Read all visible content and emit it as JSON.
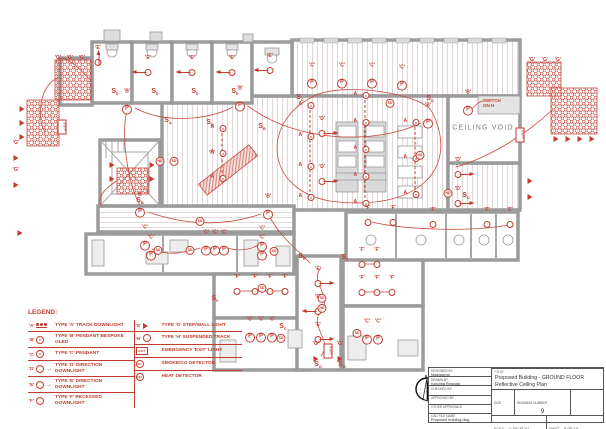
{
  "colors": {
    "annotation_red": "#c23b2e",
    "wall_gray": "#9b9b9b",
    "stripe_pink": "#e3d8d8",
    "furniture_gray": "#dedede",
    "plan_text_gray": "#7a7a7a"
  },
  "plan": {
    "ceiling_void_label": "CEILING VOID",
    "north_label": "N",
    "symbols": [
      {
        "t": "direction",
        "x": 148,
        "y": 72,
        "d": "left",
        "l": "'E'"
      },
      {
        "t": "direction",
        "x": 192,
        "y": 72,
        "d": "left",
        "l": "'E'"
      },
      {
        "t": "direction",
        "x": 232,
        "y": 72,
        "d": "left",
        "l": "'E'"
      },
      {
        "t": "direction",
        "x": 270,
        "y": 70,
        "d": "left",
        "l": "'E'"
      },
      {
        "t": "direction",
        "x": 98,
        "y": 62,
        "d": "up",
        "l": "'E'"
      },
      {
        "t": "direction",
        "x": 322,
        "y": 133,
        "d": "right",
        "l": "'D'"
      },
      {
        "t": "direction",
        "x": 322,
        "y": 181,
        "d": "right",
        "l": "'D'"
      },
      {
        "t": "direction",
        "x": 458,
        "y": 174,
        "d": "right",
        "l": "'D'"
      },
      {
        "t": "direction",
        "x": 458,
        "y": 203,
        "d": "right",
        "l": "'D'"
      },
      {
        "t": "direction",
        "x": 318,
        "y": 283,
        "d": "right",
        "l": "'E'"
      },
      {
        "t": "direction",
        "x": 318,
        "y": 311,
        "d": "left",
        "l": "'E'"
      },
      {
        "t": "direction",
        "x": 318,
        "y": 339,
        "d": "right",
        "l": "'E'"
      },
      {
        "t": "pendant",
        "x": 312,
        "y": 80,
        "l": "'C'"
      },
      {
        "t": "pendant",
        "x": 342,
        "y": 80,
        "l": "'C'"
      },
      {
        "t": "pendant",
        "x": 372,
        "y": 80,
        "l": "'C'"
      },
      {
        "t": "pendant",
        "x": 402,
        "y": 82,
        "l": "'C'"
      },
      {
        "t": "pendant",
        "x": 127,
        "y": 106,
        "l": "'B'"
      },
      {
        "t": "pendant",
        "x": 240,
        "y": 103,
        "l": "'B'"
      },
      {
        "t": "pendant",
        "x": 428,
        "y": 120,
        "l": "'B'"
      },
      {
        "t": "pendant",
        "x": 468,
        "y": 107,
        "l": "'B'"
      },
      {
        "t": "pendant",
        "x": 140,
        "y": 209,
        "l": "'B'"
      },
      {
        "t": "pendant",
        "x": 268,
        "y": 211,
        "l": "'B'"
      },
      {
        "t": "pendant",
        "x": 145,
        "y": 242,
        "l": "'C'"
      },
      {
        "t": "pendant",
        "x": 151,
        "y": 252,
        "l": "'C'"
      },
      {
        "t": "pendant",
        "x": 206,
        "y": 247,
        "l": "'C'"
      },
      {
        "t": "pendant",
        "x": 215,
        "y": 247,
        "l": "'C'"
      },
      {
        "t": "pendant",
        "x": 224,
        "y": 247,
        "l": "'C'"
      },
      {
        "t": "pendant",
        "x": 262,
        "y": 243,
        "l": "'C'"
      },
      {
        "t": "pendant",
        "x": 262,
        "y": 252,
        "l": "'C'"
      },
      {
        "t": "pendant",
        "x": 250,
        "y": 334,
        "l": "'C'"
      },
      {
        "t": "pendant",
        "x": 261,
        "y": 334,
        "l": "'C'"
      },
      {
        "t": "pendant",
        "x": 272,
        "y": 334,
        "l": "'C'"
      },
      {
        "t": "pendant",
        "x": 367,
        "y": 336,
        "l": "'C'"
      },
      {
        "t": "pendant",
        "x": 378,
        "y": 336,
        "l": "'C'"
      },
      {
        "t": "track",
        "x": 222,
        "y": 128,
        "h": 50,
        "n": 3,
        "l": "A"
      },
      {
        "t": "track",
        "x": 310,
        "y": 105,
        "h": 92,
        "n": 4,
        "l": "A"
      },
      {
        "t": "track",
        "x": 365,
        "y": 95,
        "h": 108,
        "n": 5,
        "l": "A"
      },
      {
        "t": "track",
        "x": 415,
        "y": 122,
        "h": 72,
        "n": 3,
        "l": "A"
      },
      {
        "t": "downlight",
        "x": 368,
        "y": 222,
        "l": "'F'"
      },
      {
        "t": "downlight",
        "x": 393,
        "y": 222,
        "l": "'F'"
      },
      {
        "t": "downlight",
        "x": 433,
        "y": 224,
        "l": "'F'"
      },
      {
        "t": "downlight",
        "x": 487,
        "y": 224,
        "l": "'F'"
      },
      {
        "t": "downlight",
        "x": 510,
        "y": 224,
        "l": "'F'"
      },
      {
        "t": "downlight",
        "x": 237,
        "y": 291,
        "l": "'F'"
      },
      {
        "t": "downlight",
        "x": 255,
        "y": 291,
        "l": "'F'"
      },
      {
        "t": "downlight",
        "x": 270,
        "y": 291,
        "l": "'F'"
      },
      {
        "t": "downlight",
        "x": 285,
        "y": 291,
        "l": "'F'"
      },
      {
        "t": "downlight",
        "x": 362,
        "y": 264,
        "l": "'F'"
      },
      {
        "t": "downlight",
        "x": 377,
        "y": 264,
        "l": "'F'"
      },
      {
        "t": "downlight",
        "x": 362,
        "y": 292,
        "l": "'F'"
      },
      {
        "t": "downlight",
        "x": 377,
        "y": 292,
        "l": "'F'"
      },
      {
        "t": "downlight",
        "x": 392,
        "y": 292,
        "l": "'F'"
      },
      {
        "t": "detector",
        "x": 158,
        "y": 247,
        "tx": "SD"
      },
      {
        "t": "detector",
        "x": 190,
        "y": 247,
        "tx": "SD"
      },
      {
        "t": "detector",
        "x": 274,
        "y": 248,
        "tx": "SD"
      },
      {
        "t": "detector",
        "x": 262,
        "y": 285,
        "tx": "SD"
      },
      {
        "t": "detector",
        "x": 281,
        "y": 335,
        "tx": "SD"
      },
      {
        "t": "detector",
        "x": 357,
        "y": 330,
        "tx": "SD"
      },
      {
        "t": "detector",
        "x": 322,
        "y": 295,
        "tx": "SD"
      },
      {
        "t": "detector",
        "x": 322,
        "y": 305,
        "tx": "HD"
      },
      {
        "t": "detector",
        "x": 390,
        "y": 100,
        "tx": "SD"
      },
      {
        "t": "detector",
        "x": 420,
        "y": 152,
        "tx": "HD"
      },
      {
        "t": "detector",
        "x": 448,
        "y": 190,
        "tx": "HD"
      },
      {
        "t": "detector",
        "x": 160,
        "y": 158,
        "tx": "HD"
      },
      {
        "t": "detector",
        "x": 174,
        "y": 158,
        "tx": "SD"
      },
      {
        "t": "detector",
        "x": 200,
        "y": 218,
        "tx": "SD"
      },
      {
        "t": "exit",
        "x": 62,
        "y": 129
      },
      {
        "t": "exit",
        "x": 520,
        "y": 137
      },
      {
        "t": "exit",
        "x": 328,
        "y": 353
      },
      {
        "t": "star",
        "x": 16,
        "y": 157,
        "l": "'G'"
      },
      {
        "t": "star",
        "x": 16,
        "y": 184,
        "l": "'G'"
      },
      {
        "t": "star",
        "x": 20,
        "y": 232
      },
      {
        "t": "star",
        "x": 530,
        "y": 180
      },
      {
        "t": "star",
        "x": 530,
        "y": 196
      },
      {
        "t": "star",
        "x": 316,
        "y": 358,
        "l": "'G'"
      },
      {
        "t": "star",
        "x": 340,
        "y": 358,
        "l": "'G'"
      },
      {
        "t": "star",
        "x": 112,
        "y": 164
      },
      {
        "t": "star",
        "x": 112,
        "y": 178
      },
      {
        "t": "star",
        "x": 152,
        "y": 164
      },
      {
        "t": "star",
        "x": 152,
        "y": 178
      },
      {
        "t": "star",
        "x": 22,
        "y": 108
      },
      {
        "t": "star",
        "x": 22,
        "y": 122
      },
      {
        "t": "star",
        "x": 22,
        "y": 136
      },
      {
        "t": "star",
        "x": 556,
        "y": 138
      },
      {
        "t": "star",
        "x": 568,
        "y": 138
      },
      {
        "t": "star",
        "x": 580,
        "y": 138
      },
      {
        "t": "star",
        "x": 592,
        "y": 138
      },
      {
        "t": "glabel",
        "x": 58,
        "y": 55,
        "tx": "'G'"
      },
      {
        "t": "glabel",
        "x": 70,
        "y": 55,
        "tx": "'G'"
      },
      {
        "t": "glabel",
        "x": 82,
        "y": 55,
        "tx": "'G'"
      },
      {
        "t": "glabel",
        "x": 532,
        "y": 57,
        "tx": "'G'"
      },
      {
        "t": "glabel",
        "x": 545,
        "y": 57,
        "tx": "'G'"
      },
      {
        "t": "glabel",
        "x": 558,
        "y": 57,
        "tx": "'G'"
      },
      {
        "t": "glabel",
        "x": 212,
        "y": 150,
        "tx": "'H'"
      },
      {
        "t": "switch",
        "x": 115,
        "y": 92,
        "s": "E"
      },
      {
        "t": "switch",
        "x": 155,
        "y": 92,
        "s": "E"
      },
      {
        "t": "switch",
        "x": 195,
        "y": 92,
        "s": "E"
      },
      {
        "t": "switch",
        "x": 235,
        "y": 92,
        "s": "E"
      },
      {
        "t": "switch",
        "x": 300,
        "y": 98,
        "s": "C"
      },
      {
        "t": "switch",
        "x": 168,
        "y": 121,
        "s": "A"
      },
      {
        "t": "switch",
        "x": 210,
        "y": 123,
        "s": "H"
      },
      {
        "t": "switch",
        "x": 262,
        "y": 127,
        "s": "B"
      },
      {
        "t": "switch",
        "x": 140,
        "y": 201,
        "s": "B"
      },
      {
        "t": "switch",
        "x": 302,
        "y": 257,
        "s": "E"
      },
      {
        "t": "switch",
        "x": 345,
        "y": 258,
        "s": "F"
      },
      {
        "t": "switch",
        "x": 318,
        "y": 365,
        "s": "G"
      },
      {
        "t": "switch",
        "x": 342,
        "y": 365,
        "s": "G"
      },
      {
        "t": "switch",
        "x": 466,
        "y": 196,
        "s": "D"
      },
      {
        "t": "switch",
        "x": 430,
        "y": 99,
        "s": "D"
      },
      {
        "t": "switch",
        "x": 215,
        "y": 299,
        "s": "F"
      },
      {
        "t": "switch",
        "x": 283,
        "y": 327,
        "s": "C"
      },
      {
        "t": "note",
        "x": 483,
        "y": 99,
        "ls": [
          "SWITCH",
          "ON H"
        ]
      }
    ]
  },
  "legend": {
    "title": "LEGEND:",
    "left_items": [
      {
        "symbol": "track-downlight",
        "key": "'A'",
        "label": "TYPE 'A' TRACK DOWNLIGHT"
      },
      {
        "symbol": "pendant",
        "key": "'B'",
        "label": "TYPE 'B' PENDANT BESPOKE OLED"
      },
      {
        "symbol": "pendant",
        "key": "'C'",
        "label": "TYPE 'C' PENDANT"
      },
      {
        "symbol": "direction-downlight",
        "key": "'D'",
        "label": "TYPE 'D' DIRECTION DOWNLIGHT"
      },
      {
        "symbol": "direction-downlight",
        "key": "'E'",
        "label": "TYPE 'E' DIRECTION DOWNLIGHT"
      },
      {
        "symbol": "recessed-downlight",
        "key": "'F'",
        "label": "TYPE 'F' RECESSED DOWNLIGHT"
      }
    ],
    "right_items": [
      {
        "symbol": "step-wall-light",
        "key": "'G'",
        "label": "TYPE 'G' STEP/WALL LIGHT"
      },
      {
        "symbol": "suspended-track",
        "key": "'H'",
        "label": "TYPE 'H' SUSPENDED TRACK"
      },
      {
        "symbol": "exit-light",
        "key": "EXIT",
        "label": "EMERGENCY 'EXIT' LIGHT"
      },
      {
        "symbol": "smoke-detector",
        "key": "SD",
        "label": "SMOKE/CO DETECTOR"
      },
      {
        "symbol": "heat-detector",
        "key": "HD",
        "label": "HEAT DETECTOR"
      }
    ]
  },
  "title_block": {
    "designed_by_label": "DESIGNED BY",
    "designed_by": "Magdalena",
    "drawn_by_label": "DRAWN BY",
    "drawn_by": "Karolina Regnala",
    "checked_by_label": "CHECKED BY",
    "checked_by": "",
    "approved_by_label": "APPROVED BY",
    "approved_by": "",
    "other_approvals_label": "OTHER APPROVALS",
    "other_approvals": "",
    "cad_file_label": "CAD FILE NAME",
    "cad_file": "Proposed building.dwg",
    "title_label": "TITLE",
    "title_line1": "Proposed Building - GROUND FLOOR",
    "title_line2": "Reflective Ceiling Plan",
    "size_label": "SIZE",
    "drawing_number_label": "DRAWING NUMBER",
    "drawing_number": "9",
    "scale_label": "SCALE",
    "scale": "1:100 AT A1",
    "sheet_label": "SHEET",
    "sheet": "9 OF 10"
  }
}
